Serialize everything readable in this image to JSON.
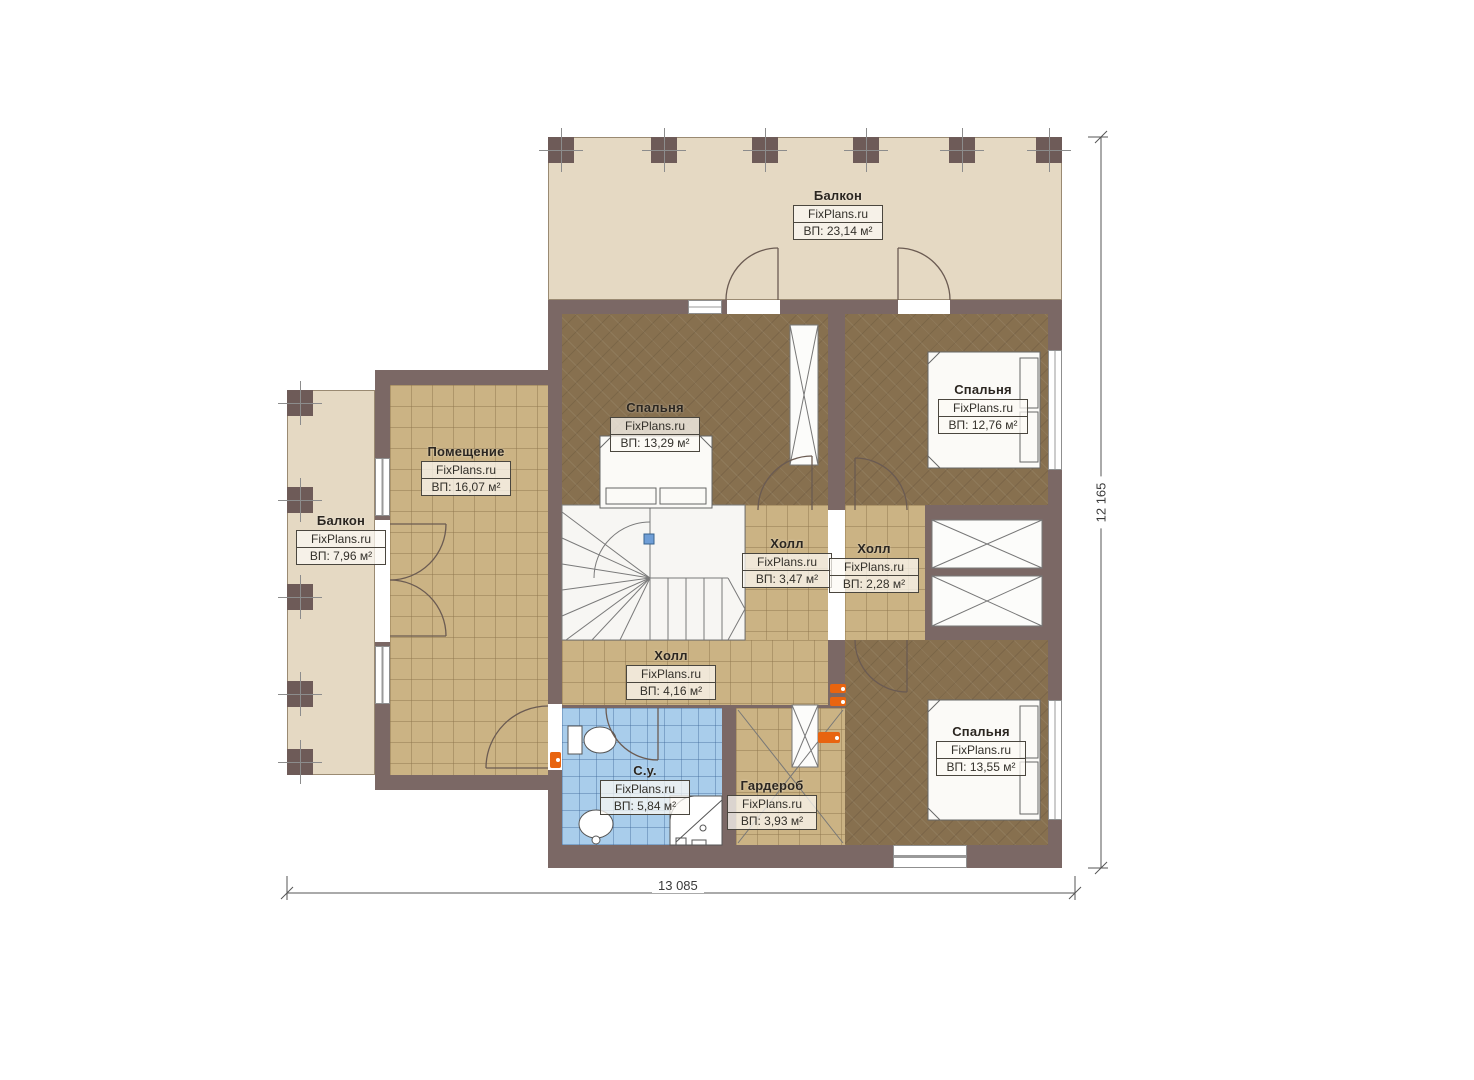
{
  "plan": {
    "watermark": "FixPlans.ru",
    "rooms": [
      {
        "id": "balcony-top",
        "name": "Балкон",
        "area": "ВП: 23,14 м²"
      },
      {
        "id": "balcony-left",
        "name": "Балкон",
        "area": "ВП: 7,96 м²"
      },
      {
        "id": "pomeschenie",
        "name": "Помещение",
        "area": "ВП: 16,07 м²"
      },
      {
        "id": "bedroom-1",
        "name": "Спальня",
        "area": "ВП: 13,29 м²"
      },
      {
        "id": "bedroom-2",
        "name": "Спальня",
        "area": "ВП: 12,76 м²"
      },
      {
        "id": "hall-1",
        "name": "Холл",
        "area": "ВП: 3,47 м²"
      },
      {
        "id": "hall-2",
        "name": "Холл",
        "area": "ВП: 2,28 м²"
      },
      {
        "id": "hall-3",
        "name": "Холл",
        "area": "ВП: 4,16 м²"
      },
      {
        "id": "bathroom",
        "name": "С.у.",
        "area": "ВП: 5,84 м²"
      },
      {
        "id": "wardrobe",
        "name": "Гардероб",
        "area": "ВП: 3,93 м²"
      },
      {
        "id": "bedroom-3",
        "name": "Спальня",
        "area": "ВП: 13,55 м²"
      }
    ],
    "dimensions": {
      "bottom": "13 085",
      "right": "12 165"
    },
    "colors": {
      "wall": "#7b6865",
      "bedroom_floor": "#87704f",
      "tile_floor": "#cbb384",
      "bath_floor": "#a9cdeb",
      "balcony_floor": "#e5d9c3",
      "stair_fill": "#f7f6f3",
      "socket": "#e8640f",
      "stair_marker": "#6f9ed6"
    }
  }
}
